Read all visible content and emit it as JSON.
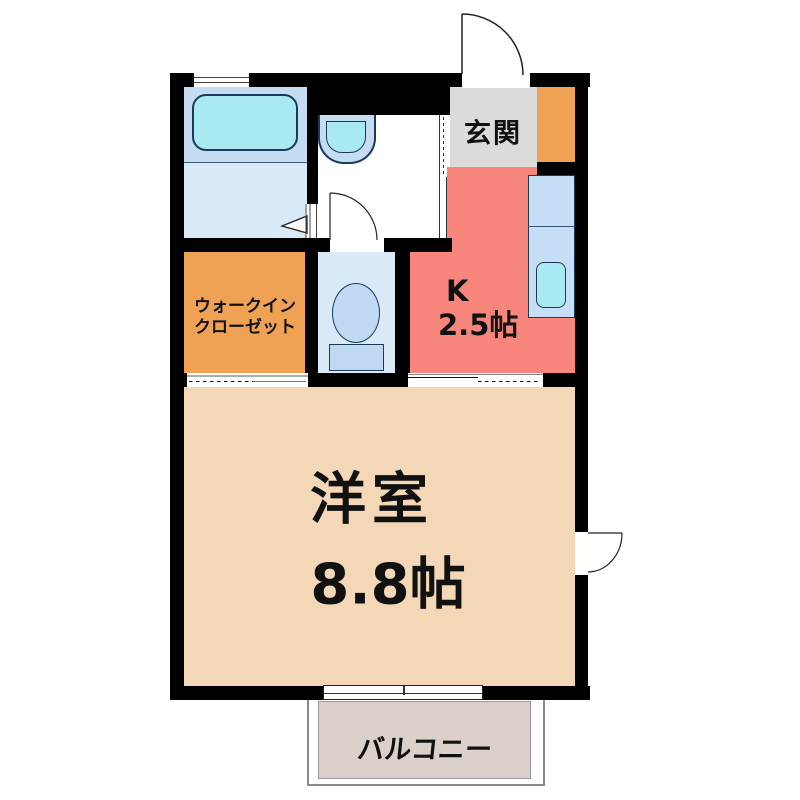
{
  "plan": {
    "type": "japanese-apartment-floor-plan",
    "rooms": {
      "genkan": {
        "label": "玄関",
        "color": "#dbdbdb"
      },
      "kitchen": {
        "label_abbr": "K",
        "label_size": "2.5帖",
        "color": "#f9867d"
      },
      "walk_in_closet": {
        "label_line1": "ウォークイン",
        "label_line2": "クローゼット",
        "color": "#efa254"
      },
      "main_room": {
        "label_name": "洋室",
        "label_size": "8.8帖",
        "color": "#f4d7b6"
      },
      "balcony": {
        "label": "バルコニー",
        "color": "#dbd1ca"
      },
      "bathroom": {
        "color": "#d8e9f8"
      },
      "washroom": {
        "color": "#ffffff"
      },
      "toilet_room": {
        "color": "#d8e9f8"
      },
      "shoe_cabinet": {
        "color": "#efa254"
      }
    },
    "fixtures": {
      "bathtub": {
        "fill": "#a9e9f2",
        "zone_fill": "#c6dcf2"
      },
      "washbasin": {
        "fill": "#a9e9f2",
        "outer_fill": "#c6dcf2"
      },
      "toilet_bowl": {
        "fill": "#c0d8f2"
      },
      "kitchen_counter": {
        "fill": "#c6dff6"
      },
      "kitchen_sink": {
        "fill": "#a9e9f2"
      }
    },
    "colors": {
      "wall": "#000000",
      "fixture_outline": "#1b3a5a",
      "balcony_border": "#888888"
    }
  }
}
